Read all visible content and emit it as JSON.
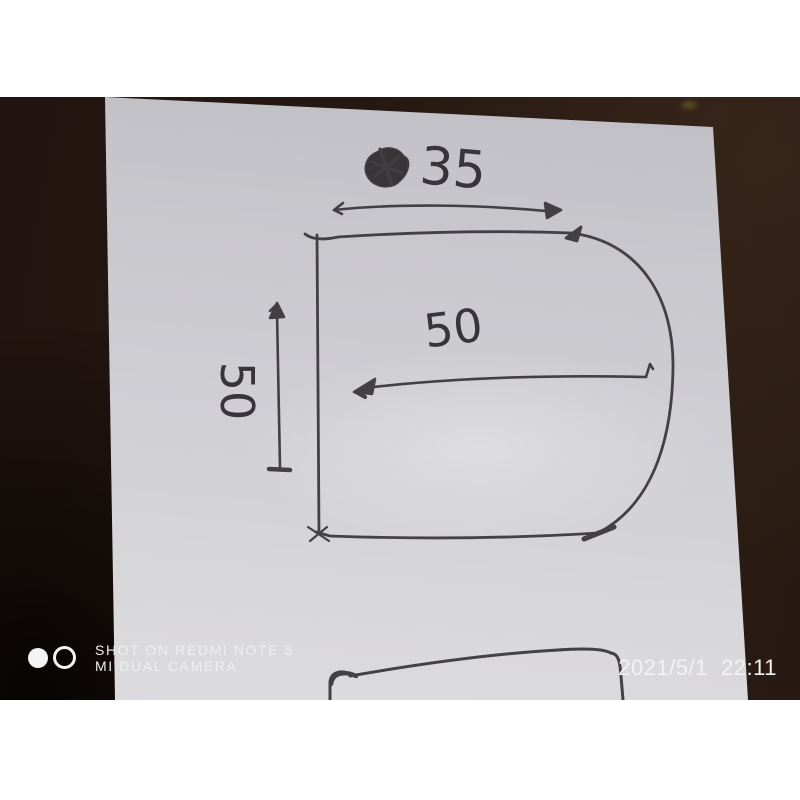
{
  "photo": {
    "sketch": {
      "top_width_label": "35",
      "inner_width_label": "50",
      "height_label": "50"
    },
    "watermark": {
      "line1": "SHOT ON REDMI NOTE 5",
      "line2": "MI DUAL CAMERA"
    },
    "timestamp": "2021/5/1  22:11",
    "icons": {
      "watermark_solid_dot": "filled-circle",
      "watermark_ring": "outlined-circle"
    },
    "colors": {
      "photo_background": "#261811",
      "paper": "#cfced2",
      "ink": "#37343a",
      "watermark_text": "#efefef"
    }
  }
}
